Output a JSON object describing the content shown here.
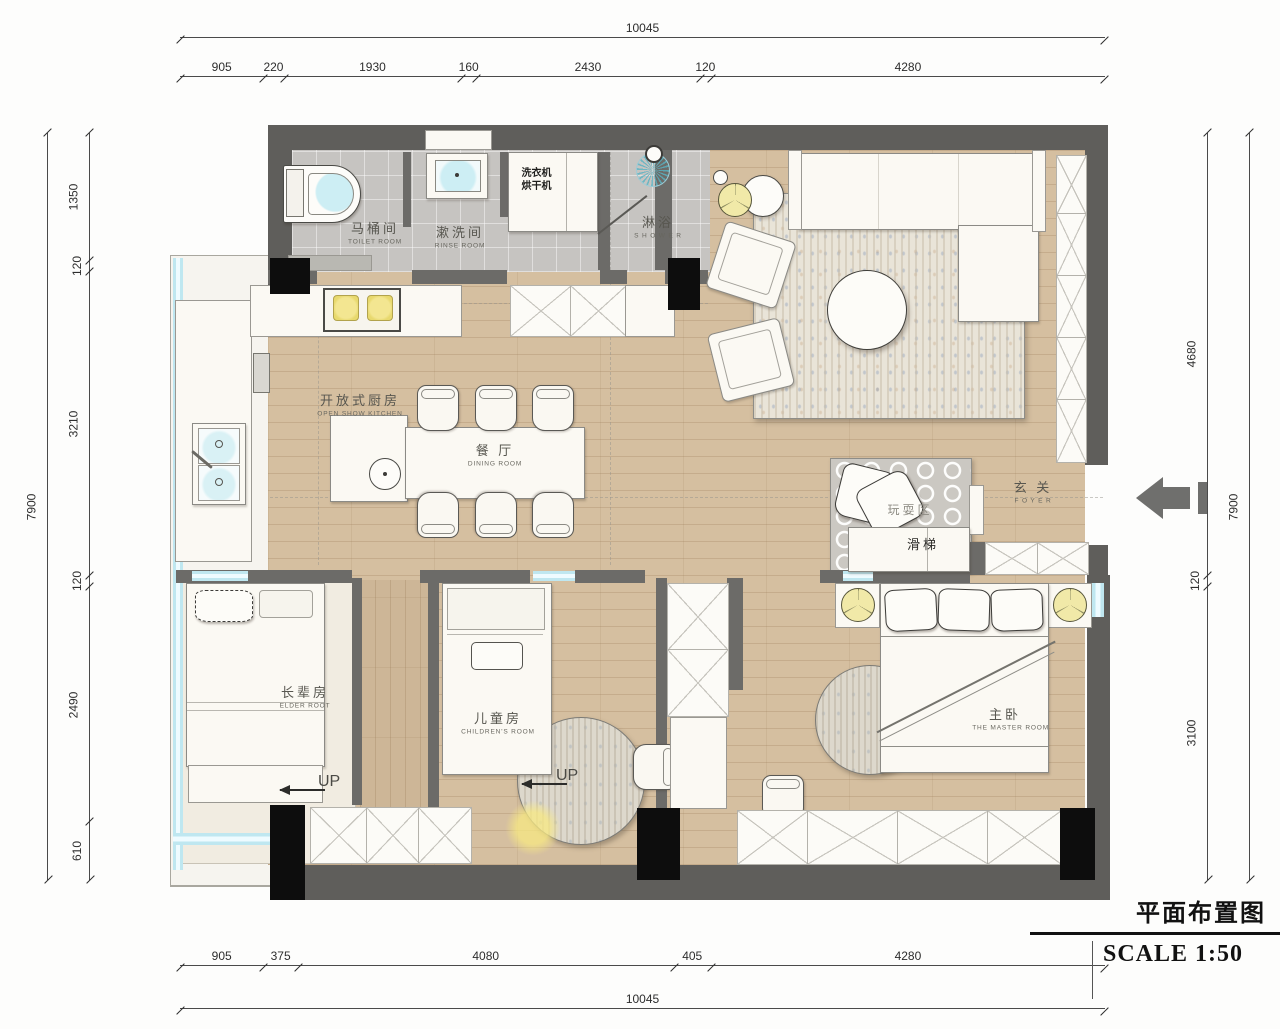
{
  "title_block": {
    "title": "平面布置图",
    "scale": "SCALE  1:50"
  },
  "labels": {
    "up": "UP"
  },
  "rooms": {
    "toilet": {
      "zh": "马桶间",
      "en": "TOILET ROOM"
    },
    "rinse": {
      "zh": "漱洗间",
      "en": "RINSE ROOM"
    },
    "laundry": {
      "line1": "洗衣机",
      "line2": "烘干机"
    },
    "shower": {
      "zh": "淋浴",
      "en": "S H O W E R"
    },
    "living": {
      "zh": "客 厅",
      "en": "LIVING  AREA"
    },
    "kitchen": {
      "zh": "开放式厨房",
      "en": "OPEN  SHOW  KITCHEN"
    },
    "dining": {
      "zh": "餐 厅",
      "en": "DINING  ROOM"
    },
    "foyer": {
      "zh": "玄 关",
      "en": "F O Y E R"
    },
    "play": {
      "zh": "玩耍区"
    },
    "slide": {
      "zh": "滑梯"
    },
    "elder": {
      "zh": "长辈房",
      "en": "ELDER  ROOT"
    },
    "children": {
      "zh": "儿童房",
      "en": "CHILDREN'S  ROOM"
    },
    "master": {
      "zh": "主卧",
      "en": "THE  MASTER  ROOM"
    }
  },
  "dimensions": {
    "top_total": [
      10045
    ],
    "top_segs": [
      905,
      220,
      1930,
      160,
      2430,
      120,
      4280
    ],
    "left_total": [
      7900
    ],
    "left_segs": [
      1350,
      120,
      3210,
      120,
      2490,
      610
    ],
    "right_segs": [
      4680,
      120,
      3100
    ],
    "right_total": [
      7900
    ],
    "bottom_segs": [
      905,
      375,
      4080,
      405,
      4280
    ],
    "bottom_total": [
      10045
    ]
  }
}
